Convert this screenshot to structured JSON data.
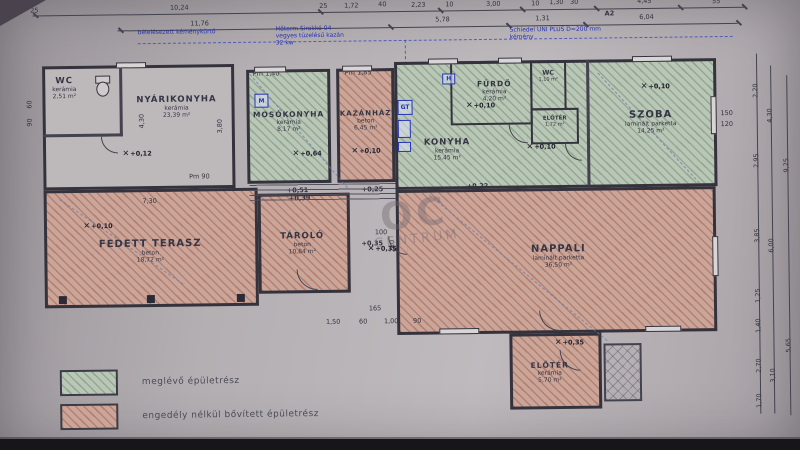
{
  "legend": {
    "existing_label": "meglévő épületrész",
    "extension_label": "engedély nélkül bővített épületrész"
  },
  "watermark": {
    "logo": "OC",
    "word": "CENTRUM"
  },
  "icons": {
    "elevation_marker": "✕"
  },
  "annotations": {
    "left_note": [
      "bélelésezett kéménykürtő"
    ],
    "boiler_note": [
      "Hőterm Sirokkó 04",
      "vegyes tüzelésű kazán",
      "32 kw"
    ],
    "chimney_note": [
      "Schiedel UNI PLUS D=200 mm",
      "kémény"
    ],
    "section_marker": "A2"
  },
  "rooms": [
    {
      "name": "WC",
      "material": "kerámia",
      "area": "2,51 m²",
      "elevation": ""
    },
    {
      "name": "NYÁRIKONYHA",
      "material": "kerámia",
      "area": "23,39 m²",
      "elevation": "+0,12"
    },
    {
      "name": "MOSÓKONYHA",
      "material": "kerámia",
      "area": "8,17 m²",
      "elevation": "+0,64"
    },
    {
      "name": "KAZÁNHÁZ",
      "material": "beton",
      "area": "6,45 m²",
      "elevation": "+0,10"
    },
    {
      "name": "FÜRDŐ",
      "material": "kerámia",
      "area": "4,20 m²",
      "elevation": "+0,10"
    },
    {
      "name": "WC",
      "material": "kerámia",
      "area": "1,10 m²",
      "elevation": ""
    },
    {
      "name": "ELŐTÉR",
      "material": "kerámia",
      "area": "1,72 m²",
      "elevation": ""
    },
    {
      "name": "KONYHA",
      "material": "kerámia",
      "area": "15,45 m²",
      "elevation": "+0,10"
    },
    {
      "name": "SZOBA",
      "material": "laminált parketta",
      "area": "14,25 m²",
      "elevation": "+0,10"
    },
    {
      "name": "FEDETT TERASZ",
      "material": "beton",
      "area": "18,72 m²",
      "elevation": "+0,10"
    },
    {
      "name": "TÁROLÓ",
      "material": "beton",
      "area": "10,84 m²",
      "elevation": "+0,35"
    },
    {
      "name": "NAPPALI",
      "material": "laminált parketta",
      "area": "36,50 m²",
      "elevation": "+0,22"
    },
    {
      "name": "ELŐTÉR",
      "material": "kerámia",
      "area": "5,70 m²",
      "elevation": "+0,35"
    }
  ],
  "dims": {
    "top_row1": [
      "25",
      "10,24",
      "25",
      "1,72",
      "40",
      "2,23",
      "10",
      "3,00",
      "10",
      "1,30",
      "30",
      "4,45",
      "55"
    ],
    "top_row2": [
      "11,76",
      "5,78",
      "1,31",
      "6,04"
    ],
    "right_chain1": [
      "2,20",
      "2,95",
      "3,85",
      "1,25",
      "1,40",
      "2,70",
      "1,70"
    ],
    "right_chain2": [
      "4,30",
      "6,00",
      "3,10"
    ],
    "right_chain3": [
      "9,25",
      "5,65"
    ],
    "left_chain": [
      "60",
      "90"
    ],
    "interior": {
      "nyari_v1": "4,30",
      "nyari_v2": "3,80",
      "pm90": "Pm 90",
      "pm140": "Pm 1,40",
      "pm185": "Pm 1,85",
      "terasz_w": "7,30",
      "door_w": "100",
      "door_h": "210",
      "window_w": "150",
      "window_h": "120",
      "bottom_row": [
        "1,50",
        "60",
        "1,00",
        "90"
      ],
      "bottom_165": "165"
    },
    "steps": [
      "+0,51",
      "+0,39",
      "+0,25",
      "+0,35",
      "+0,22"
    ]
  },
  "fixtures": {
    "washer": "M",
    "sink": "H",
    "stove": "GT"
  }
}
